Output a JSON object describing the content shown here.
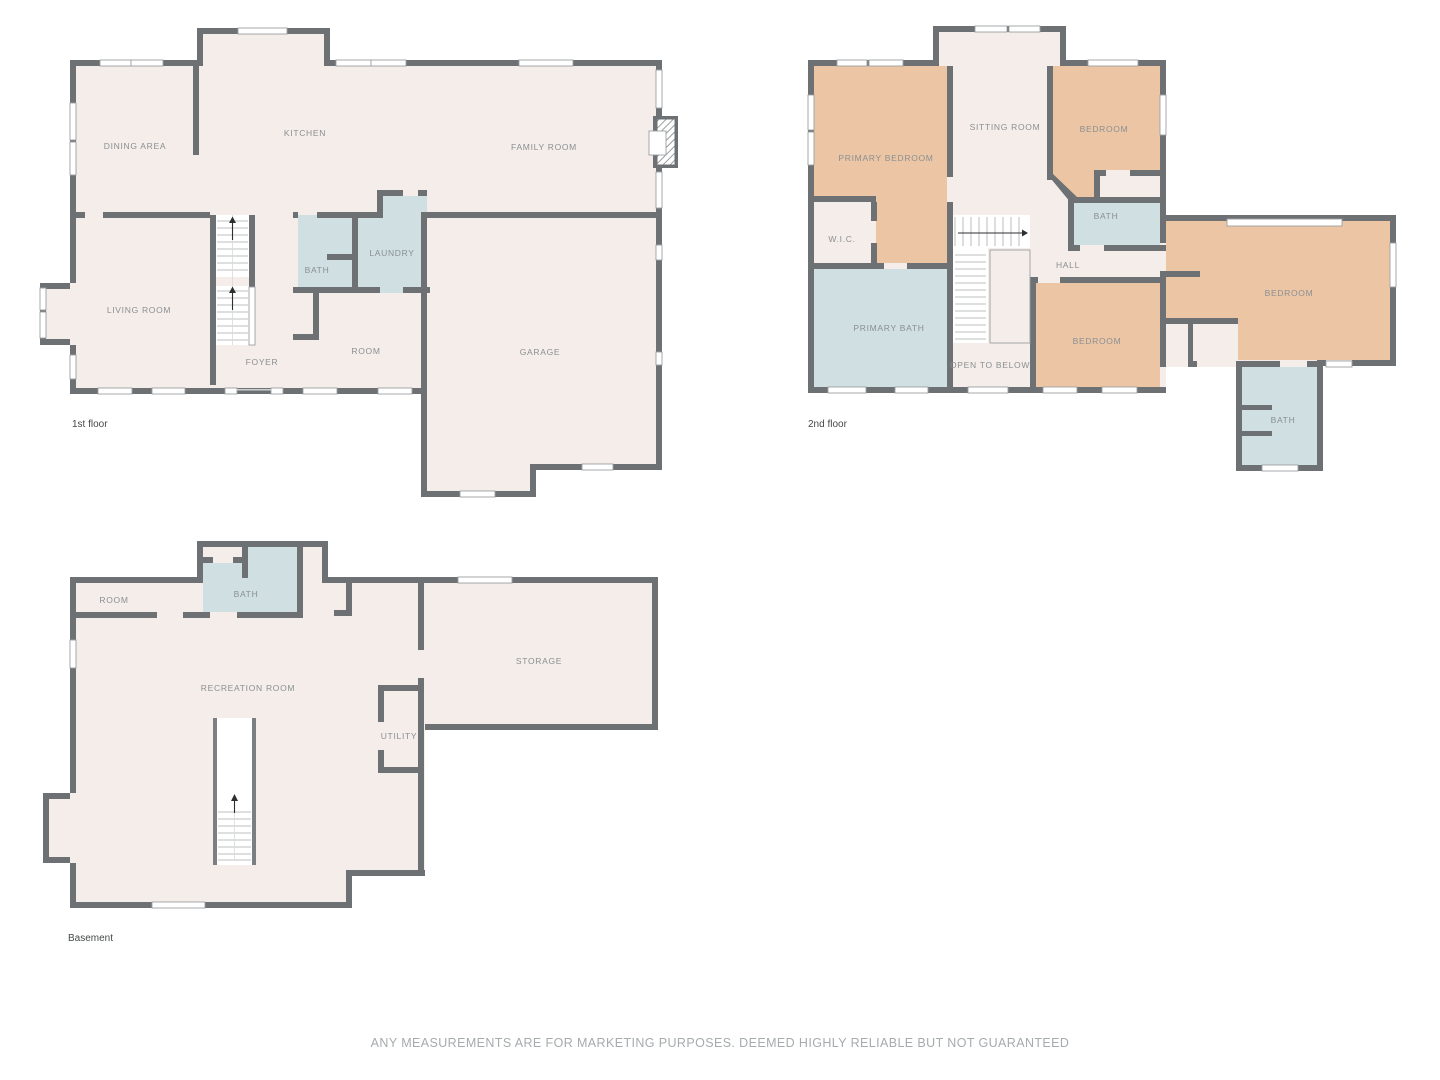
{
  "footer": {
    "disclaimer": "ANY MEASUREMENTS ARE FOR MARKETING PURPOSES. DEEMED HIGHLY RELIABLE BUT NOT GUARANTEED"
  },
  "colors": {
    "wall": "#6e7173",
    "floor": "#f5ede9",
    "bath": "#cfdfe2",
    "bedroom": "#ecc6a4",
    "label": "#8a8f92"
  },
  "floors": {
    "first": {
      "label": "1st floor",
      "rooms": {
        "dining": "DINING AREA",
        "kitchen": "KITCHEN",
        "family": "FAMILY ROOM",
        "living": "LIVING ROOM",
        "bath": "BATH",
        "laundry": "LAUNDRY",
        "foyer": "FOYER",
        "room": "ROOM",
        "garage": "GARAGE"
      }
    },
    "second": {
      "label": "2nd floor",
      "rooms": {
        "primary_bedroom": "PRIMARY BEDROOM",
        "sitting": "SITTING ROOM",
        "bedroom_top": "BEDROOM",
        "wic": "W.I.C.",
        "bath_mid": "BATH",
        "hall": "HALL",
        "primary_bath": "PRIMARY BATH",
        "open_below": "OPEN TO BELOW",
        "bedroom_mid": "BEDROOM",
        "bedroom_right": "BEDROOM",
        "bath_right": "BATH"
      }
    },
    "basement": {
      "label": "Basement",
      "rooms": {
        "room": "ROOM",
        "bath": "BATH",
        "recreation": "RECREATION ROOM",
        "storage": "STORAGE",
        "utility": "UTILITY"
      }
    }
  }
}
